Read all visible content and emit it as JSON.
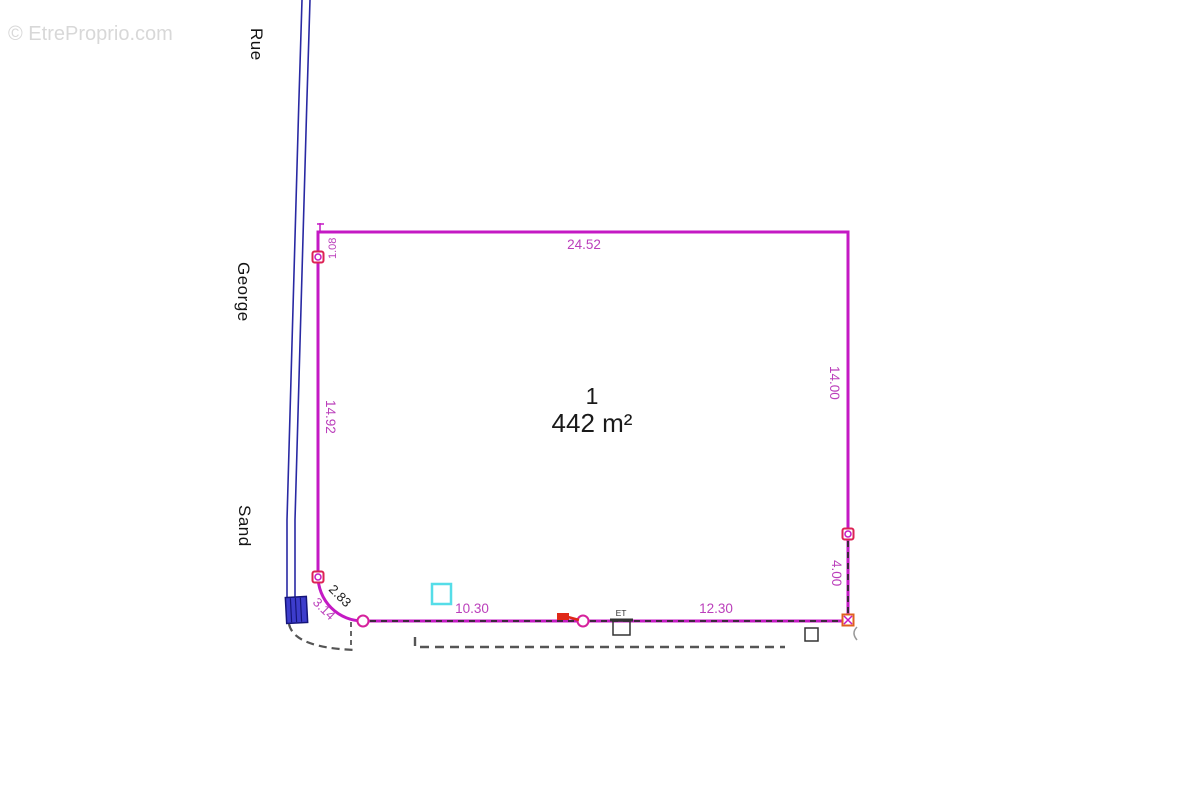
{
  "watermark": {
    "text": "© EtreProprio.com"
  },
  "street": {
    "word1": "Rue",
    "word2": "George",
    "word3": "Sand"
  },
  "parcel": {
    "lot_number": "1",
    "area": "442 m²"
  },
  "dimensions": {
    "top": "24.52",
    "left": "14.92",
    "right_upper": "14.00",
    "right_lower": "4.00",
    "bottom_left": "10.30",
    "bottom_right": "12.30",
    "corner_arc_outer": "2.83",
    "corner_arc_inner": "3.14",
    "top_corner": "1.08"
  },
  "annotations": {
    "utility_box_label": "ET"
  },
  "colors": {
    "boundary": "#c419c4",
    "dimension_text": "#bb3fbb",
    "boundary_marker": "#dd2255",
    "corner_marker": "#e06020",
    "road": "#2929a3",
    "road_feature_fill": "#3d3dcc",
    "cyan_feature": "#55dde8",
    "dashed_utility": "#555555",
    "red_symbol": "#e02818",
    "lot_text": "#1a1a1a",
    "watermark": "#d8d8d8"
  }
}
